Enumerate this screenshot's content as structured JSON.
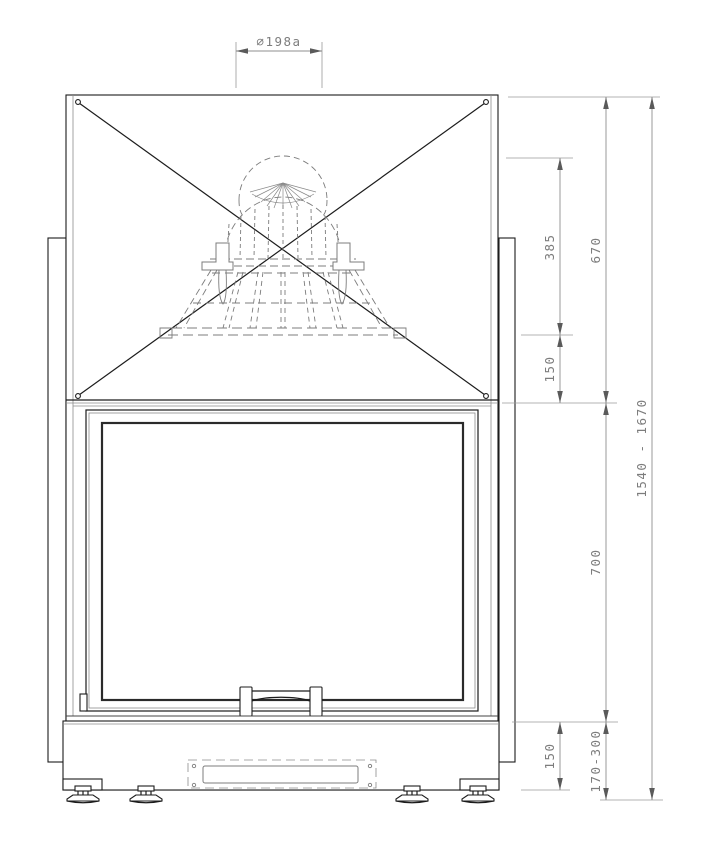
{
  "drawing": {
    "title": "Fireplace insert – front elevation",
    "view": "front view technical drawing with hidden smoke dome",
    "dimension_labels": {
      "flue_diameter": "∅198a",
      "dome_height": "385",
      "upper_section_height": "670",
      "collar_to_panel": "150",
      "door_section_height": "700",
      "base_height": "150",
      "floor_clearance_range": "170-300",
      "total_height_range": "1540 - 1670"
    },
    "colors": {
      "background": "#ffffff",
      "object_line": "#1c1c1c",
      "hidden_line": "#7c7c7c",
      "dimension_line": "#8f8f8f",
      "dimension_text": "#7d7d7d"
    }
  }
}
